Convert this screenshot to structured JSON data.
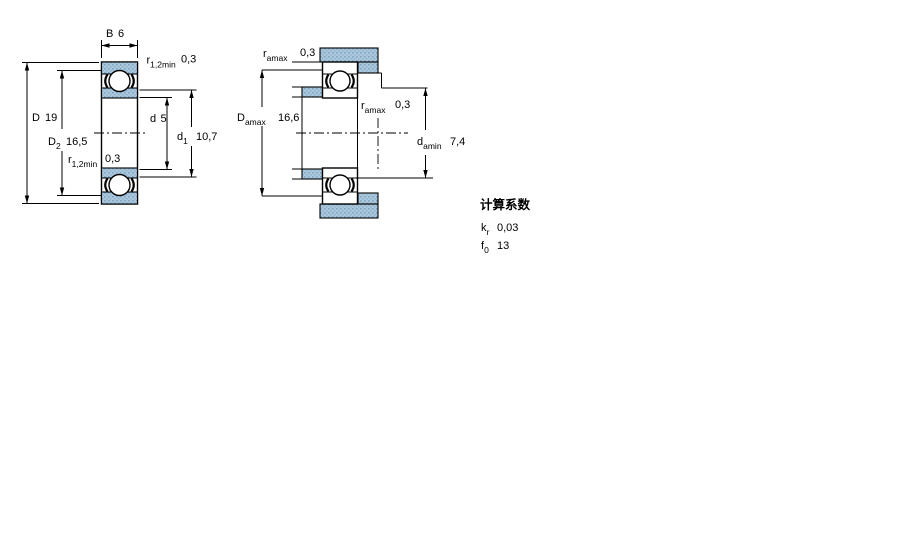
{
  "left_view": {
    "dim_B": {
      "sym": "B",
      "val": "6"
    },
    "dim_r_top": {
      "sym": "r",
      "sub": "1,2min",
      "val": "0,3"
    },
    "dim_D": {
      "sym": "D",
      "val": "19"
    },
    "dim_D2": {
      "sym": "D",
      "sub": "2",
      "val": "16,5"
    },
    "dim_d": {
      "sym": "d",
      "val": "5"
    },
    "dim_d1": {
      "sym": "d",
      "sub": "1",
      "val": "10,7"
    },
    "dim_r_bottom": {
      "sym": "r",
      "sub": "1,2min",
      "val": "0,3"
    }
  },
  "right_view": {
    "dim_ra_top": {
      "sym": "r",
      "sub": "amax",
      "val": "0,3"
    },
    "dim_Da": {
      "sym": "D",
      "sub": "amax",
      "val": "16,6"
    },
    "dim_ra_mid": {
      "sym": "r",
      "sub": "amax",
      "val": "0,3"
    },
    "dim_da": {
      "sym": "d",
      "sub": "amin",
      "val": "7,4"
    }
  },
  "calc_factors": {
    "title": "计算系数",
    "rows": [
      {
        "sym": "k",
        "sub": "r",
        "val": "0,03"
      },
      {
        "sym": "f",
        "sub": "0",
        "val": "13"
      }
    ]
  },
  "colors": {
    "section_fill": "#abc7dc",
    "section_dot_dark": "#7fa6c5",
    "section_dot_mid": "#93b6cf",
    "line": "#000000",
    "background": "#ffffff"
  }
}
